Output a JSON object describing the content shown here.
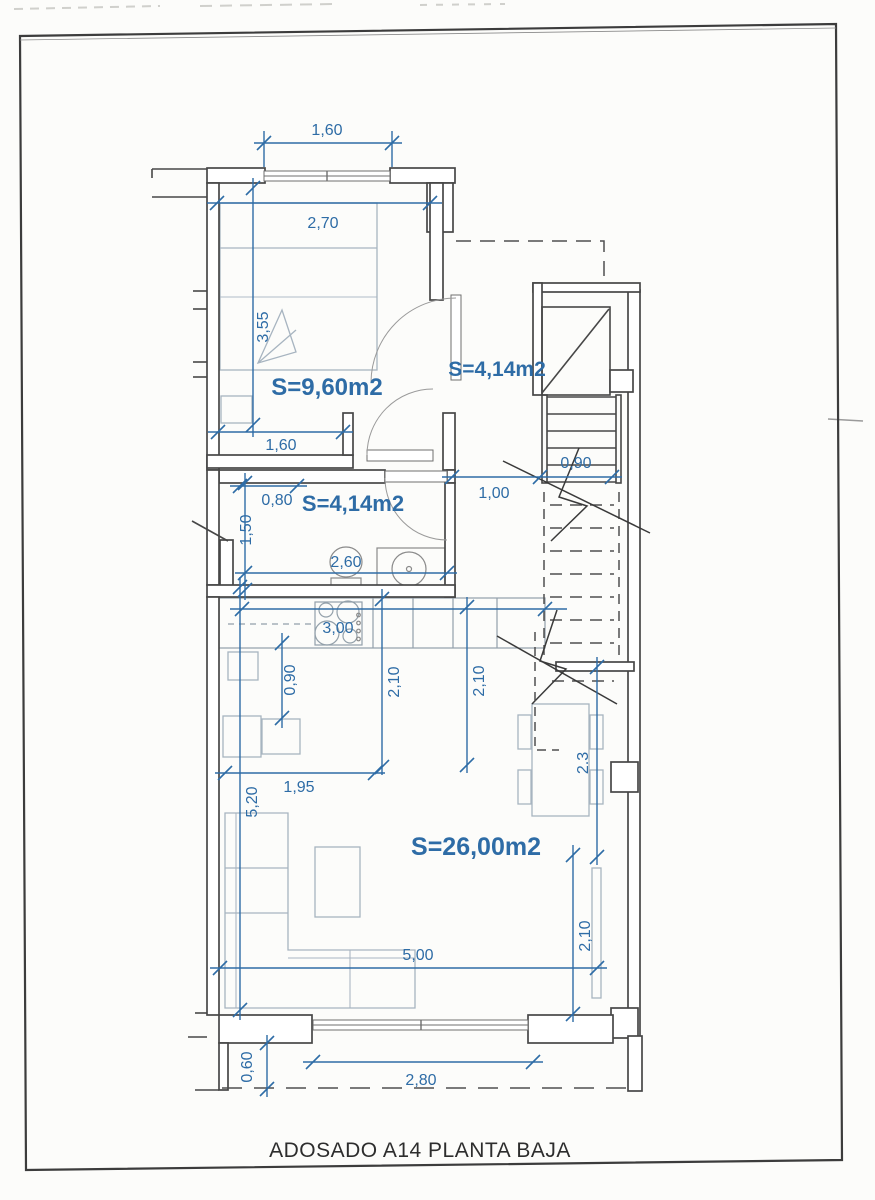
{
  "title": "ADOSADO A14  PLANTA BAJA",
  "colors": {
    "dimension_blue": "#2e6ca6",
    "wall_dark": "#474747",
    "furniture_gray": "#a7b4c0",
    "paper": "#fcfcfa"
  },
  "rooms": {
    "bedroom": {
      "label": "S=9,60m2"
    },
    "hall_upper": {
      "label": "S=4,14m2"
    },
    "bathroom": {
      "label": "S=4,14m2"
    },
    "living": {
      "label": "S=26,00m2"
    }
  },
  "dims": {
    "top_window_w": "1,60",
    "bedroom_w": "2,70",
    "bedroom_h": "3,55",
    "bedroom_door_wall": "1,60",
    "bath_shelf": "0,80",
    "bath_left_h": "1,50",
    "bath_w": "2,60",
    "entry_w": "1,00",
    "stair_w": "0,90",
    "kitchen_w": "3,00",
    "kitchen_d": "0,90",
    "kitchen_h1": "2,10",
    "kitchen_h2": "2,10",
    "sofa_wall": "1,95",
    "living_h": "5,20",
    "dining_h": "2.3",
    "living_w": "5,00",
    "right_window_h": "2,10",
    "terrace_d": "0,60",
    "terrace_window_w": "2,80"
  }
}
